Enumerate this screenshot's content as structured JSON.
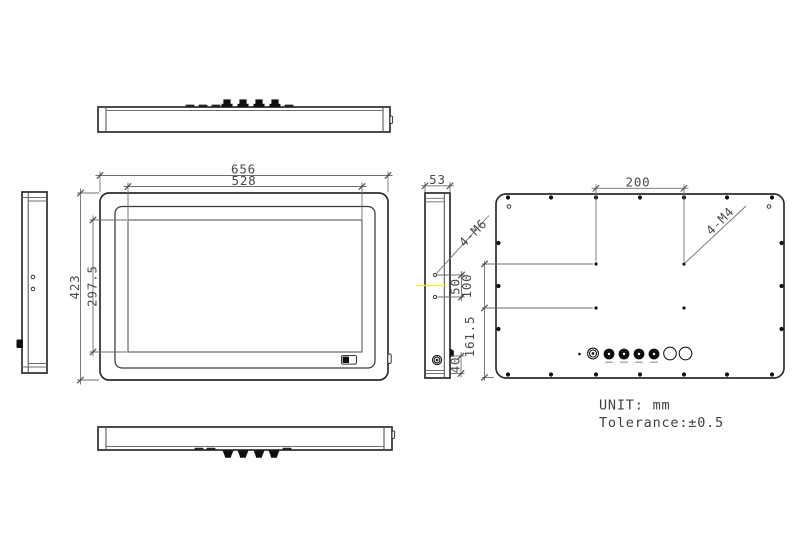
{
  "drawing": {
    "front_view": {
      "outer_width": "656",
      "screen_width": "528",
      "outer_height": "423",
      "screen_height": "297.5"
    },
    "side_view": {
      "depth": "53",
      "mount_holes": "4-M6",
      "hole_spacing": "50",
      "bottom_offset": "40"
    },
    "back_view": {
      "vesa_width": "200",
      "mount_holes": "4-M4",
      "vesa_height": "100",
      "vesa_to_bottom": "161.5"
    },
    "notes": {
      "unit": "UNIT: mm",
      "tolerance": "Tolerance:±0.5"
    }
  }
}
